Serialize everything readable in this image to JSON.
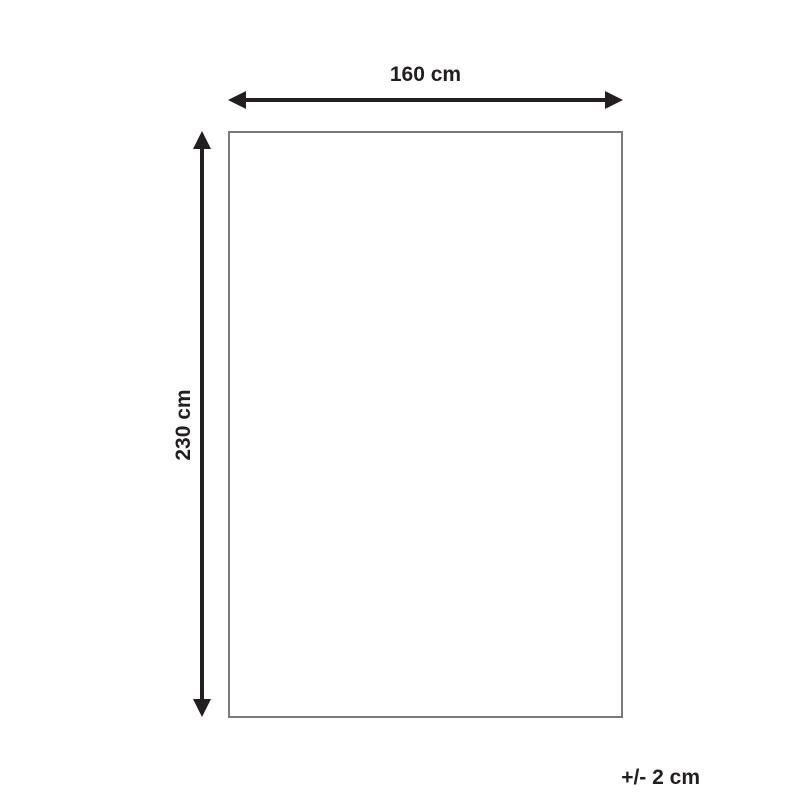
{
  "diagram": {
    "type": "product-dimension-diagram",
    "width_label": "160 cm",
    "height_label": "230 cm",
    "tolerance_label": "+/- 2 cm",
    "colors": {
      "arrow": "#231f20",
      "rectangle_border": "#7a7a7a",
      "background": "#ffffff"
    }
  }
}
